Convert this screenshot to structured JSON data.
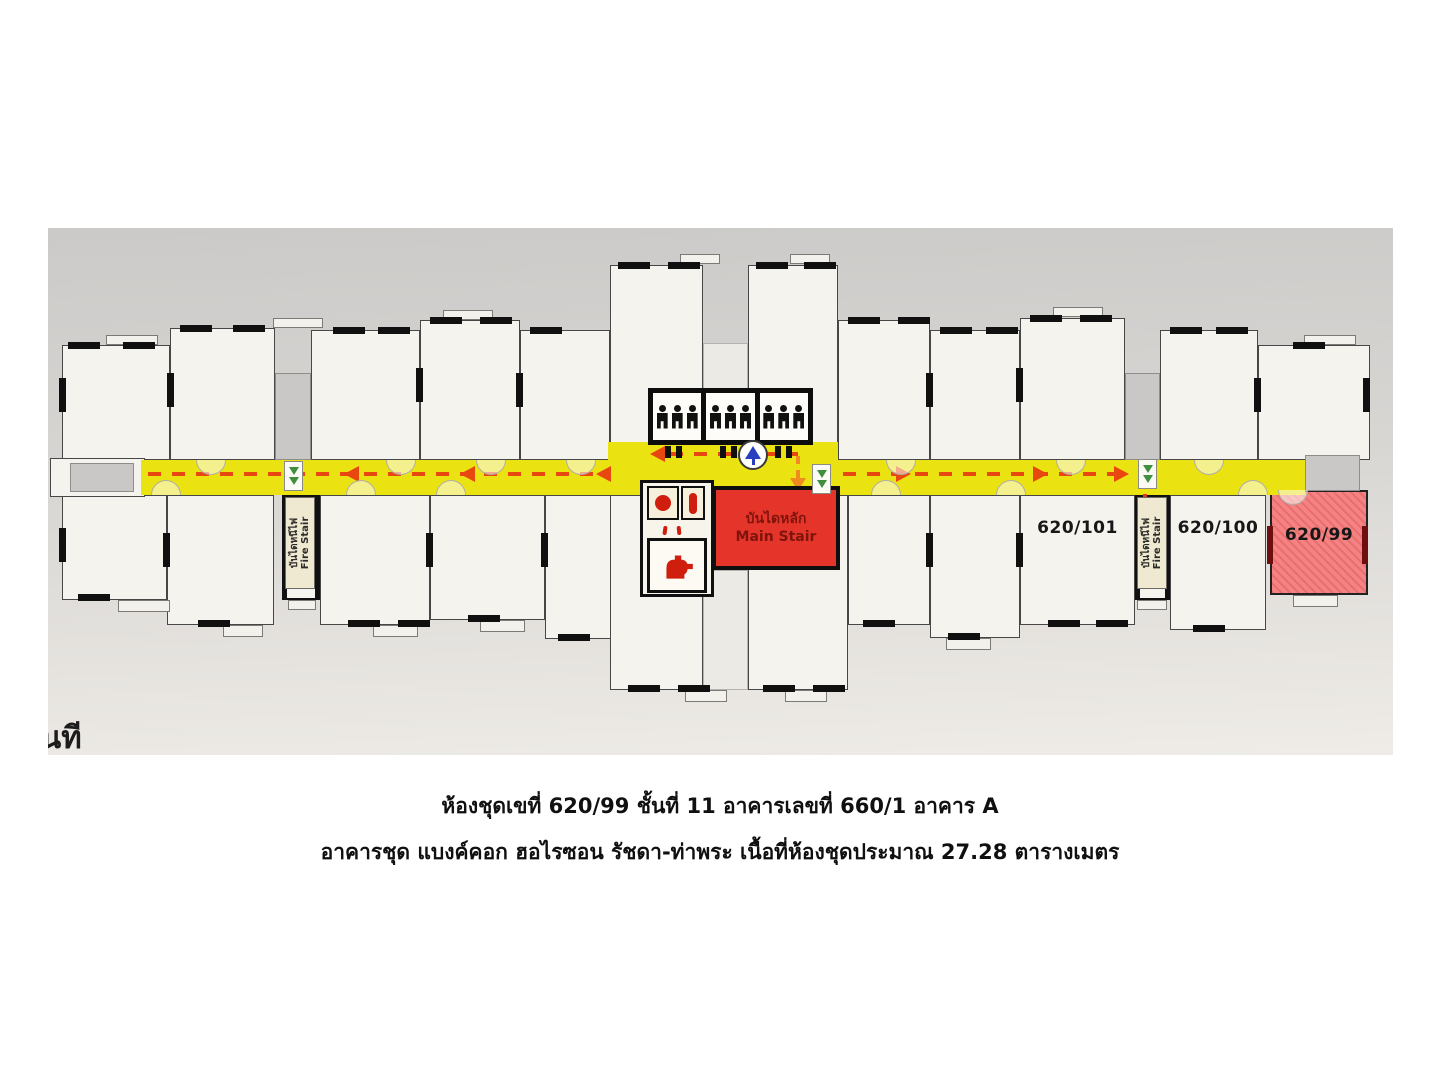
{
  "plan": {
    "units": {
      "unit_101": "620/101",
      "unit_100": "620/100",
      "unit_99": "620/99"
    },
    "main_stair": {
      "label_thai": "บันไดหลัก",
      "label_en": "Main Stair"
    },
    "fire_stair": {
      "label_thai": "บันไดหนีไฟ",
      "label_en": "Fire Stair"
    },
    "partial_text": "นที",
    "colors": {
      "corridor_yellow": "#ebe211",
      "route_red": "#e8470f",
      "exit_green": "#3f8f3f",
      "down_arrow_red": "#d93a20",
      "turn_arrow_orange": "#ef8b1f",
      "main_stair_red": "#e5352a",
      "main_stair_text": "#7f140d",
      "highlight_unit_red": "#f58383",
      "fire_label_cream": "#efe9d2",
      "vestibule_gray": "#c9c8c6",
      "wall_black": "#101010",
      "compass_blue": "#2a3fc0"
    }
  },
  "caption": {
    "line1": "ห้องชุดเขที่ 620/99 ชั้นที่ 11 อาคารเลขที่ 660/1 อาคาร A",
    "line2": "อาคารชุด แบงค์คอก ฮอไรซอน รัชดา-ท่าพระ เนื้อที่ห้องชุดประมาณ 27.28 ตารางเมตร"
  }
}
